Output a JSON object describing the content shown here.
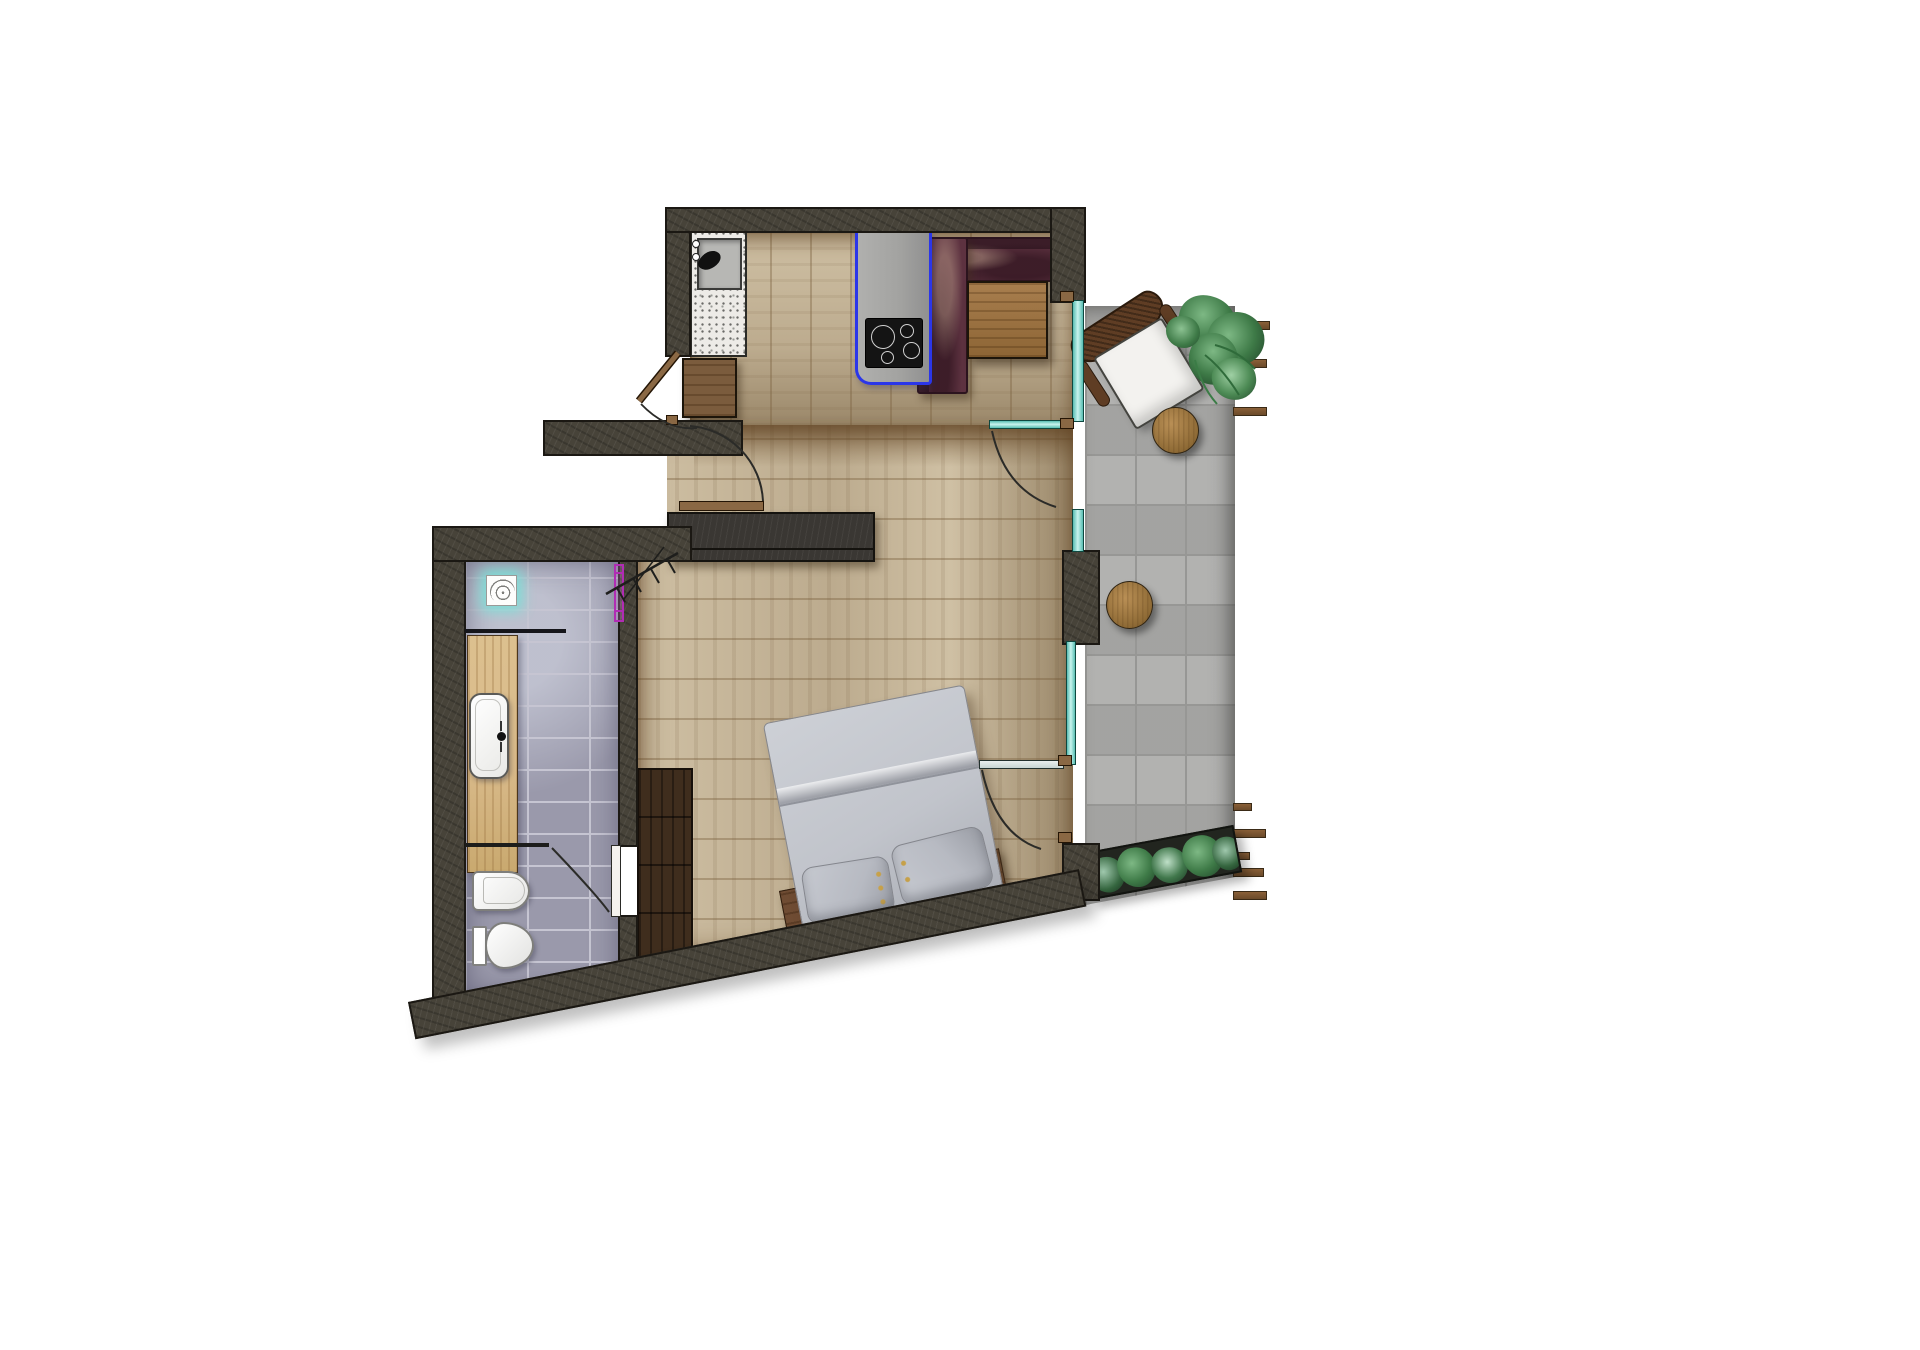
{
  "scene": {
    "kind": "architectural-floor-plan",
    "view": "top-down-render",
    "visible_text": "none",
    "rooms": [
      {
        "id": "kitchen-living",
        "floor": "light wood planks, vertical"
      },
      {
        "id": "main-room",
        "floor": "light wood planks, horizontal"
      },
      {
        "id": "bathroom",
        "floor": "gray-lavender ceramic tiles"
      },
      {
        "id": "terrace",
        "floor": "large gray concrete tiles"
      }
    ],
    "furniture": [
      {
        "id": "sink-counter",
        "desc": "terrazzo worktop with inset sink and faucet"
      },
      {
        "id": "base-cabinet",
        "desc": "wooden kitchen cabinet"
      },
      {
        "id": "kitchen-counter",
        "desc": "gray counter highlighted with blue outline"
      },
      {
        "id": "induction-cooktop",
        "burners": 4
      },
      {
        "id": "corner-sofa",
        "desc": "L-shaped burgundy sofa"
      },
      {
        "id": "coffee-table",
        "desc": "square wooden table"
      },
      {
        "id": "media-sideboard",
        "desc": "long dark low cabinet"
      },
      {
        "id": "coat-rack",
        "desc": "wall coat rack symbol"
      },
      {
        "id": "double-bed",
        "pillows": 2,
        "desc": "gray bed rotated with slanted wall"
      },
      {
        "id": "headboard-bench",
        "desc": "wooden plank headboard"
      },
      {
        "id": "wardrobe",
        "desc": "dark wood wardrobe"
      },
      {
        "id": "vanity",
        "desc": "oak vanity top with white washbasin"
      },
      {
        "id": "shower",
        "desc": "shower head symbol with teal glow and glass screen"
      },
      {
        "id": "towel-radiator",
        "desc": "magenta towel rail"
      },
      {
        "id": "wall-hung-wc",
        "desc": "white wc pan"
      },
      {
        "id": "toilet-cistern",
        "desc": "white toilet with cistern"
      },
      {
        "id": "lounge-chair",
        "desc": "wicker chair with white cushion"
      },
      {
        "id": "side-table-upper",
        "shape": "round wood"
      },
      {
        "id": "side-table-lower",
        "shape": "round wood"
      },
      {
        "id": "potted-plant",
        "desc": "green tropical plant"
      },
      {
        "id": "shrub-planter",
        "desc": "planter box with shrubs along terrace bottom"
      }
    ],
    "openings": {
      "entry-door": "hinged door shown open 90deg with swing arc",
      "secondary-door": "door leaf shown mid-swing at top-left wall",
      "bathroom-door": "door swinging into WC zone",
      "terrace-door-upper": "teal glass door with swing arc",
      "terrace-door-lower": "glass door with swing arc",
      "glazing": "teal glass wall segments between room and terrace"
    },
    "counts": {
      "terrace_slats_top": 5,
      "terrace_slats_bottom": 5,
      "cooktop_burners": 4,
      "pillows": 2,
      "wc_fixtures": 2,
      "round_tables": 2
    }
  },
  "colors": {
    "paper": "#ffffff",
    "wall": "#474339",
    "wallEdge": "#1b1813",
    "woodLight": "#cfc0a4",
    "woodMid": "#bcab8e",
    "woodDark": "#9a8769",
    "oak": "#d9ba8a",
    "cabinet": "#7b5c3d",
    "darkwood": "#3f2d1d",
    "headboard": "#6f4c33",
    "terrazzo": "#edebe7",
    "counterGray": "#a2a2a0",
    "blue": "#2b36e9",
    "cooktop": "#141414",
    "burgundy": "#5d3240",
    "burgundyDark": "#2c141e",
    "tableWood": "#a87e4e",
    "bedGray": "#c1c4cb",
    "pillowGray": "#b7bac2",
    "bathTile": "#9a99ab",
    "bathGrout": "#c6c5d2",
    "terraceTile": "#acacaa",
    "terraceGrout": "#979795",
    "teal": "#8ee4da",
    "purple": "#b12cb4",
    "slat": "#7d5835",
    "green": "#3e7a47",
    "greenDark": "#234a2c",
    "greenLight": "#7db884",
    "planterBox": "#22251f",
    "chairBrown": "#5f3d24",
    "cushion": "#f3f2ef",
    "leafWood": "#8a6844",
    "porcelain": "#fbfbfa"
  }
}
